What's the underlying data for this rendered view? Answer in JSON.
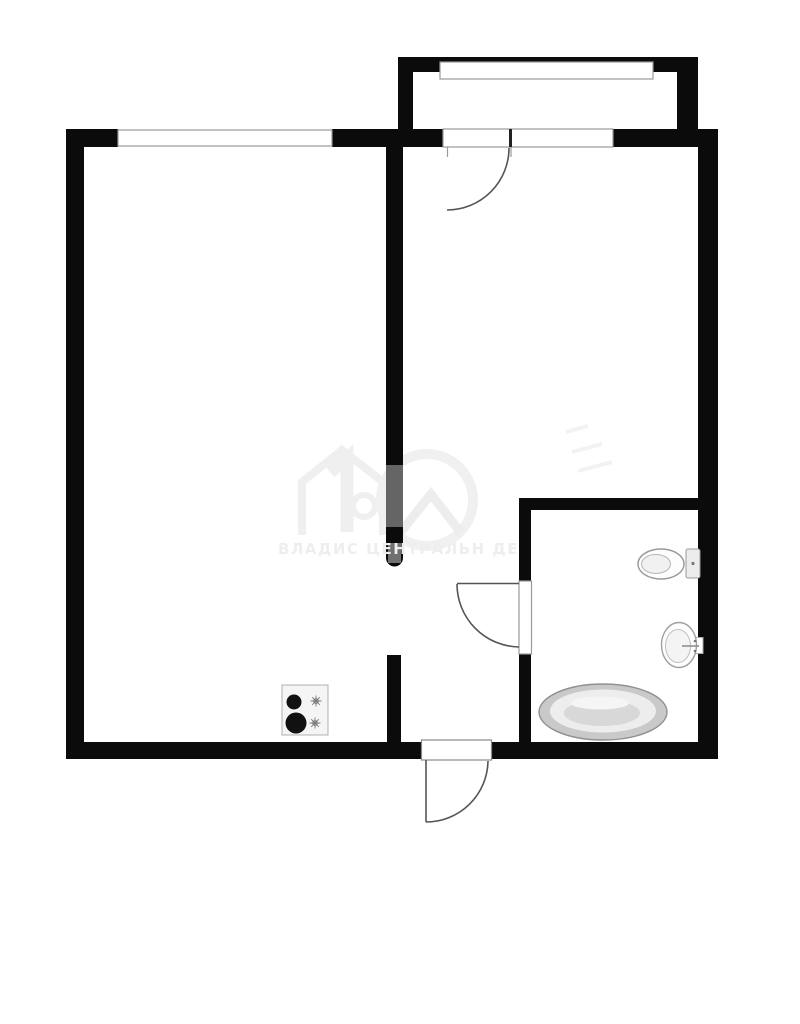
{
  "document": {
    "kind": "apartment-floor-plan",
    "background_color": "#ffffff"
  },
  "palette": {
    "wall_color": "#0b0b0b",
    "opening_outline_color": "#9a9a9a",
    "door_arc_color": "#555555",
    "fixture_outline_color": "#9a9a9a",
    "stove_fill": "#f5f5f5",
    "tub_shades": [
      "#c9c9c9",
      "#ededed",
      "#d8d8d8",
      "#f5f5f5"
    ],
    "watermark_color": "#eeeeee"
  },
  "watermark": {
    "text": "ВЛАДИС ЦЕНТРАЛЬН ДЕ",
    "logo": "house-and-circle-logo"
  },
  "rooms": [
    {
      "name": "living-room",
      "position": "left"
    },
    {
      "name": "hallway",
      "position": "right-top"
    },
    {
      "name": "kitchen",
      "position": "bottom-left"
    },
    {
      "name": "bathroom",
      "position": "bottom-right"
    },
    {
      "name": "balcony",
      "position": "top"
    }
  ],
  "openings": {
    "windows": [
      {
        "name": "living-room-window",
        "wall": "top"
      },
      {
        "name": "balcony-window",
        "wall": "top"
      }
    ],
    "doors": [
      {
        "name": "balcony-door",
        "swing": "quarter-arc"
      },
      {
        "name": "bathroom-door",
        "swing": "quarter-arc"
      },
      {
        "name": "entrance-door",
        "swing": "quarter-arc"
      }
    ]
  },
  "fixtures": [
    {
      "name": "stove",
      "burners": 4
    },
    {
      "name": "toilet"
    },
    {
      "name": "sink"
    },
    {
      "name": "bathtub"
    }
  ]
}
